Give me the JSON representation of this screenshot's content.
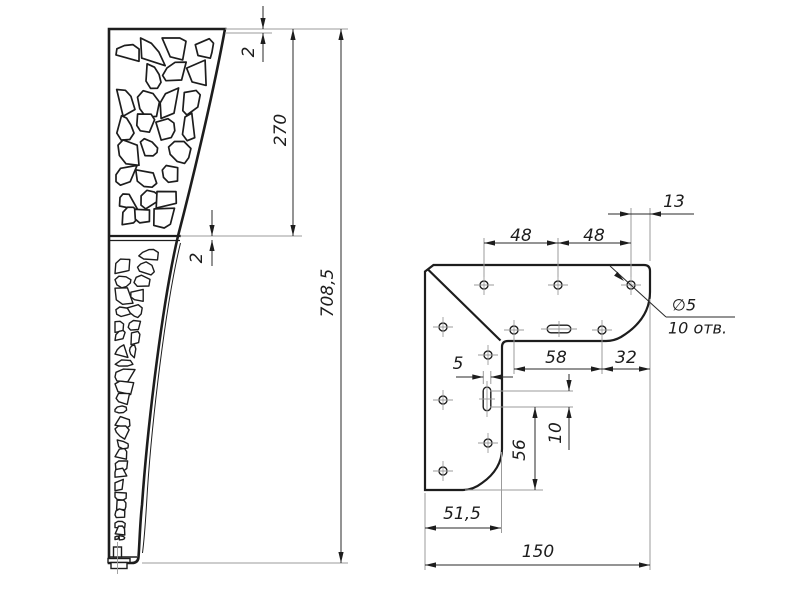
{
  "drawing": {
    "left_view": {
      "dim_thickness_top": "2",
      "dim_upper_section": "270",
      "dim_thickness_joint": "2",
      "dim_total_height": "708,5"
    },
    "right_view": {
      "dim_hole_pitch_left": "48",
      "dim_hole_pitch_right": "48",
      "dim_edge_offset": "13",
      "note_hole_dia": "∅5",
      "note_hole_count": "10 отв.",
      "dim_pitch_58": "58",
      "dim_pitch_32": "32",
      "dim_slot_width": "5",
      "dim_slot_pitch": "10",
      "dim_pitch_56": "56",
      "dim_base_width": "51,5",
      "dim_full_width": "150"
    },
    "colors": {
      "outline": "#1d1d1d",
      "thin_line": "#9b9b9b",
      "background": "#ffffff"
    }
  }
}
